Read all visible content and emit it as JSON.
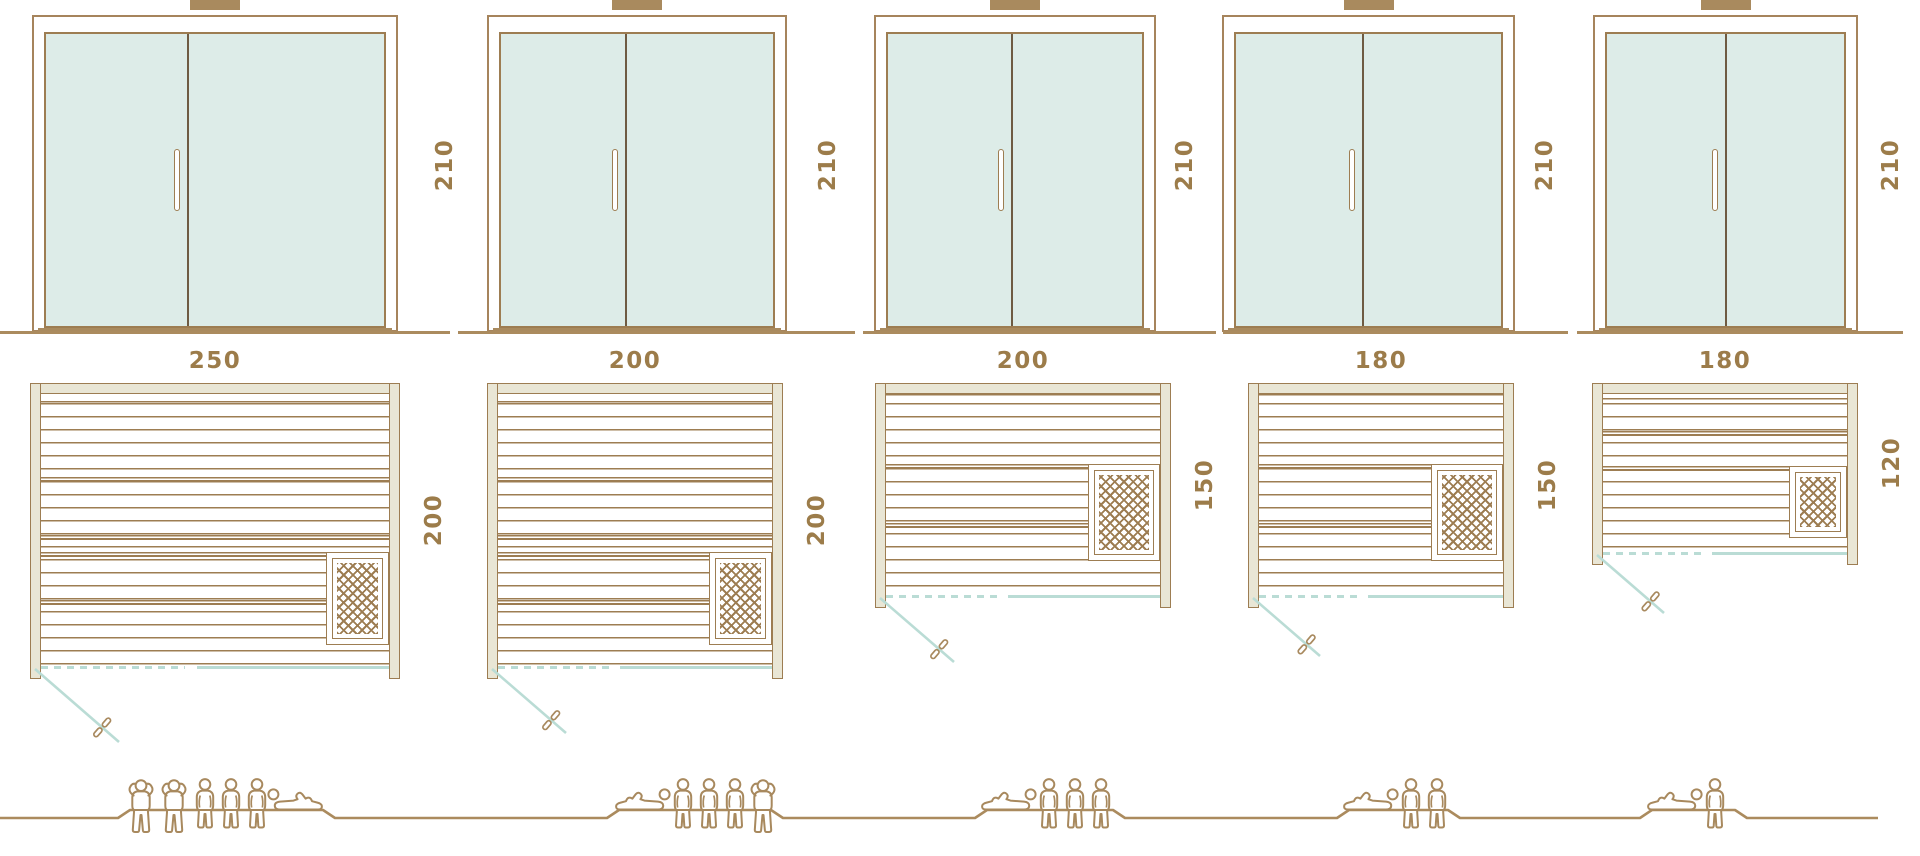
{
  "colors": {
    "line_brown": "#9d7d52",
    "frame_line": "#a6845c",
    "ground_brown": "#ab8b5e",
    "figure_brown": "#a8895e",
    "text_brown": "#9c7c4a",
    "glass_mint": "#ddece8",
    "frame_beige": "#e9e6d5",
    "teal": "#badcd5",
    "divider_dark": "#6e5b43",
    "vent_fill": "#a98a5e"
  },
  "columns": [
    {
      "door": {
        "height": "210"
      },
      "plan": {
        "width": "250",
        "depth": "200"
      },
      "capacity": {
        "total": 6,
        "figures": [
          "standing",
          "standing",
          "sitting",
          "sitting",
          "sitting",
          "lying"
        ],
        "lying_side": "right"
      }
    },
    {
      "door": {
        "height": "210"
      },
      "plan": {
        "width": "200",
        "depth": "200"
      },
      "capacity": {
        "total": 5,
        "figures": [
          "lying",
          "sitting",
          "sitting",
          "sitting",
          "standing"
        ],
        "lying_side": "left"
      }
    },
    {
      "door": {
        "height": "210"
      },
      "plan": {
        "width": "200",
        "depth": "150"
      },
      "capacity": {
        "total": 4,
        "figures": [
          "lying",
          "sitting",
          "sitting",
          "sitting"
        ],
        "lying_side": "left"
      }
    },
    {
      "door": {
        "height": "210"
      },
      "plan": {
        "width": "180",
        "depth": "150"
      },
      "capacity": {
        "total": 3,
        "figures": [
          "lying",
          "sitting",
          "sitting"
        ],
        "lying_side": "left"
      }
    },
    {
      "door": {
        "height": "210"
      },
      "plan": {
        "width": "180",
        "depth": "120"
      },
      "capacity": {
        "total": 2,
        "figures": [
          "lying",
          "sitting"
        ],
        "lying_side": "left"
      }
    }
  ]
}
